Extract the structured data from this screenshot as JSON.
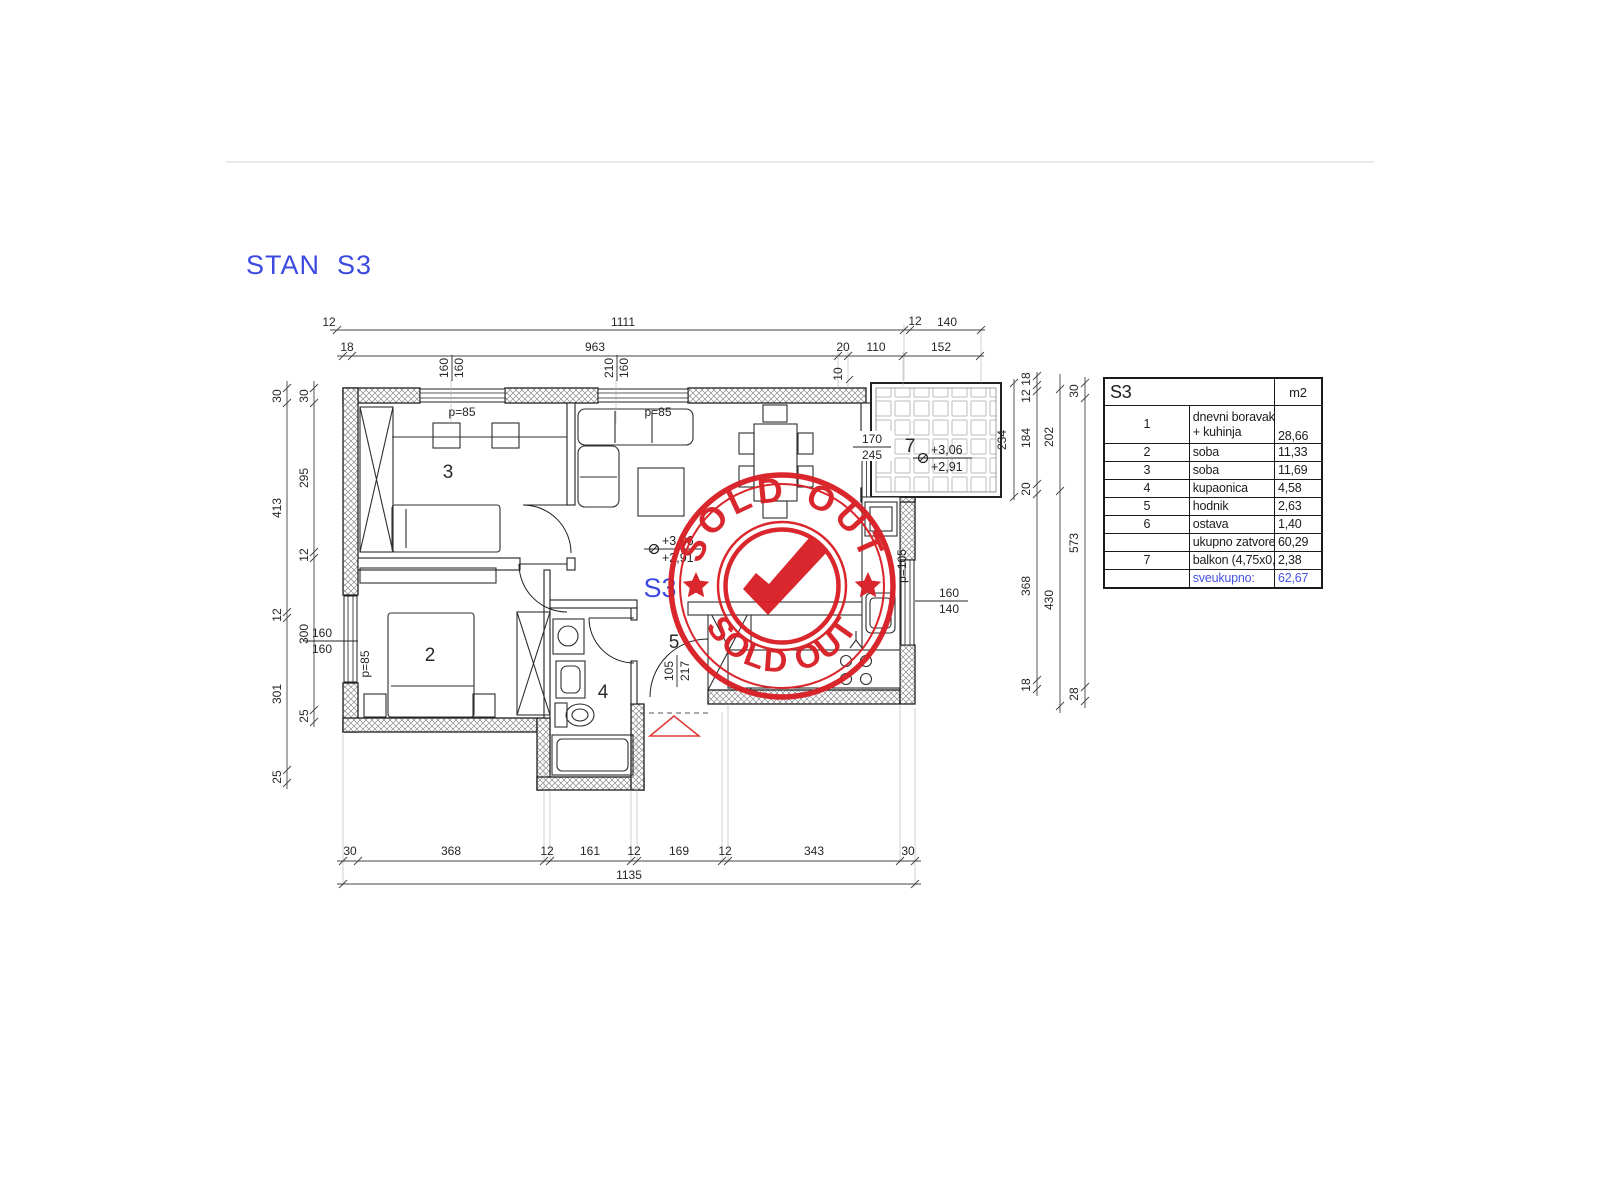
{
  "page": {
    "title": "STAN  S3"
  },
  "colors": {
    "blue": "#3d4adf",
    "red": "#d81f25"
  },
  "stamp": {
    "top": "SOLD OUT",
    "bottom": "SOLD OUT"
  },
  "plan": {
    "unit_label": "S3",
    "rooms": {
      "r2": "2",
      "r3": "3",
      "r4": "4",
      "r5": "5",
      "r7": "7"
    },
    "levels": {
      "upper": "+3,06",
      "lower": "+2,91"
    },
    "doors": {
      "entry_w": "105",
      "entry_h": "217",
      "balcony_w": "170",
      "balcony_h": "245"
    },
    "windows": {
      "w3a": "160",
      "w3b": "160",
      "wLa": "210",
      "wLb": "160",
      "w2a": "160",
      "w2b": "160",
      "wKa": "160",
      "wKb": "140",
      "p85": "p=85",
      "p105": "p=105",
      "stub": "10"
    },
    "dims": {
      "top1": [
        "12",
        "1111",
        "12",
        "140"
      ],
      "top2": [
        "18",
        "963",
        "20",
        "110",
        "152"
      ],
      "left_outer": [
        "30",
        "413",
        "12",
        "301",
        "25"
      ],
      "left_inner": [
        "30",
        "295",
        "12",
        "300",
        "25"
      ],
      "right_a": [
        "234"
      ],
      "right_b": [
        "18",
        "12",
        "184",
        "20",
        "368",
        "18"
      ],
      "right_c": [
        "202",
        "430"
      ],
      "right_d": [
        "30",
        "573",
        "28"
      ],
      "bottom1": [
        "30",
        "368",
        "12",
        "161",
        "12",
        "169",
        "12",
        "343",
        "30"
      ],
      "bottom2": [
        "1135"
      ]
    }
  },
  "table": {
    "header": {
      "unit": "S3",
      "area": "m2"
    },
    "rows": [
      {
        "num": "1",
        "name": "dnevni boravak+blag.",
        "name2": "+ kuhinja",
        "value": "28,66"
      },
      {
        "num": "2",
        "name": "soba",
        "value": "11,33"
      },
      {
        "num": "3",
        "name": "soba",
        "value": "11,69"
      },
      {
        "num": "4",
        "name": "kupaonica",
        "value": "4,58"
      },
      {
        "num": "5",
        "name": "hodnik",
        "value": "2,63"
      },
      {
        "num": "6",
        "name": "ostava",
        "value": "1,40"
      },
      {
        "num": "",
        "name": "ukupno zatvoreno:",
        "value": "60,29"
      },
      {
        "num": "7",
        "name": "balkon (4,75x0,50)",
        "value": "2,38"
      },
      {
        "num": "",
        "name": "sveukupno:",
        "value": "62,67"
      }
    ]
  }
}
